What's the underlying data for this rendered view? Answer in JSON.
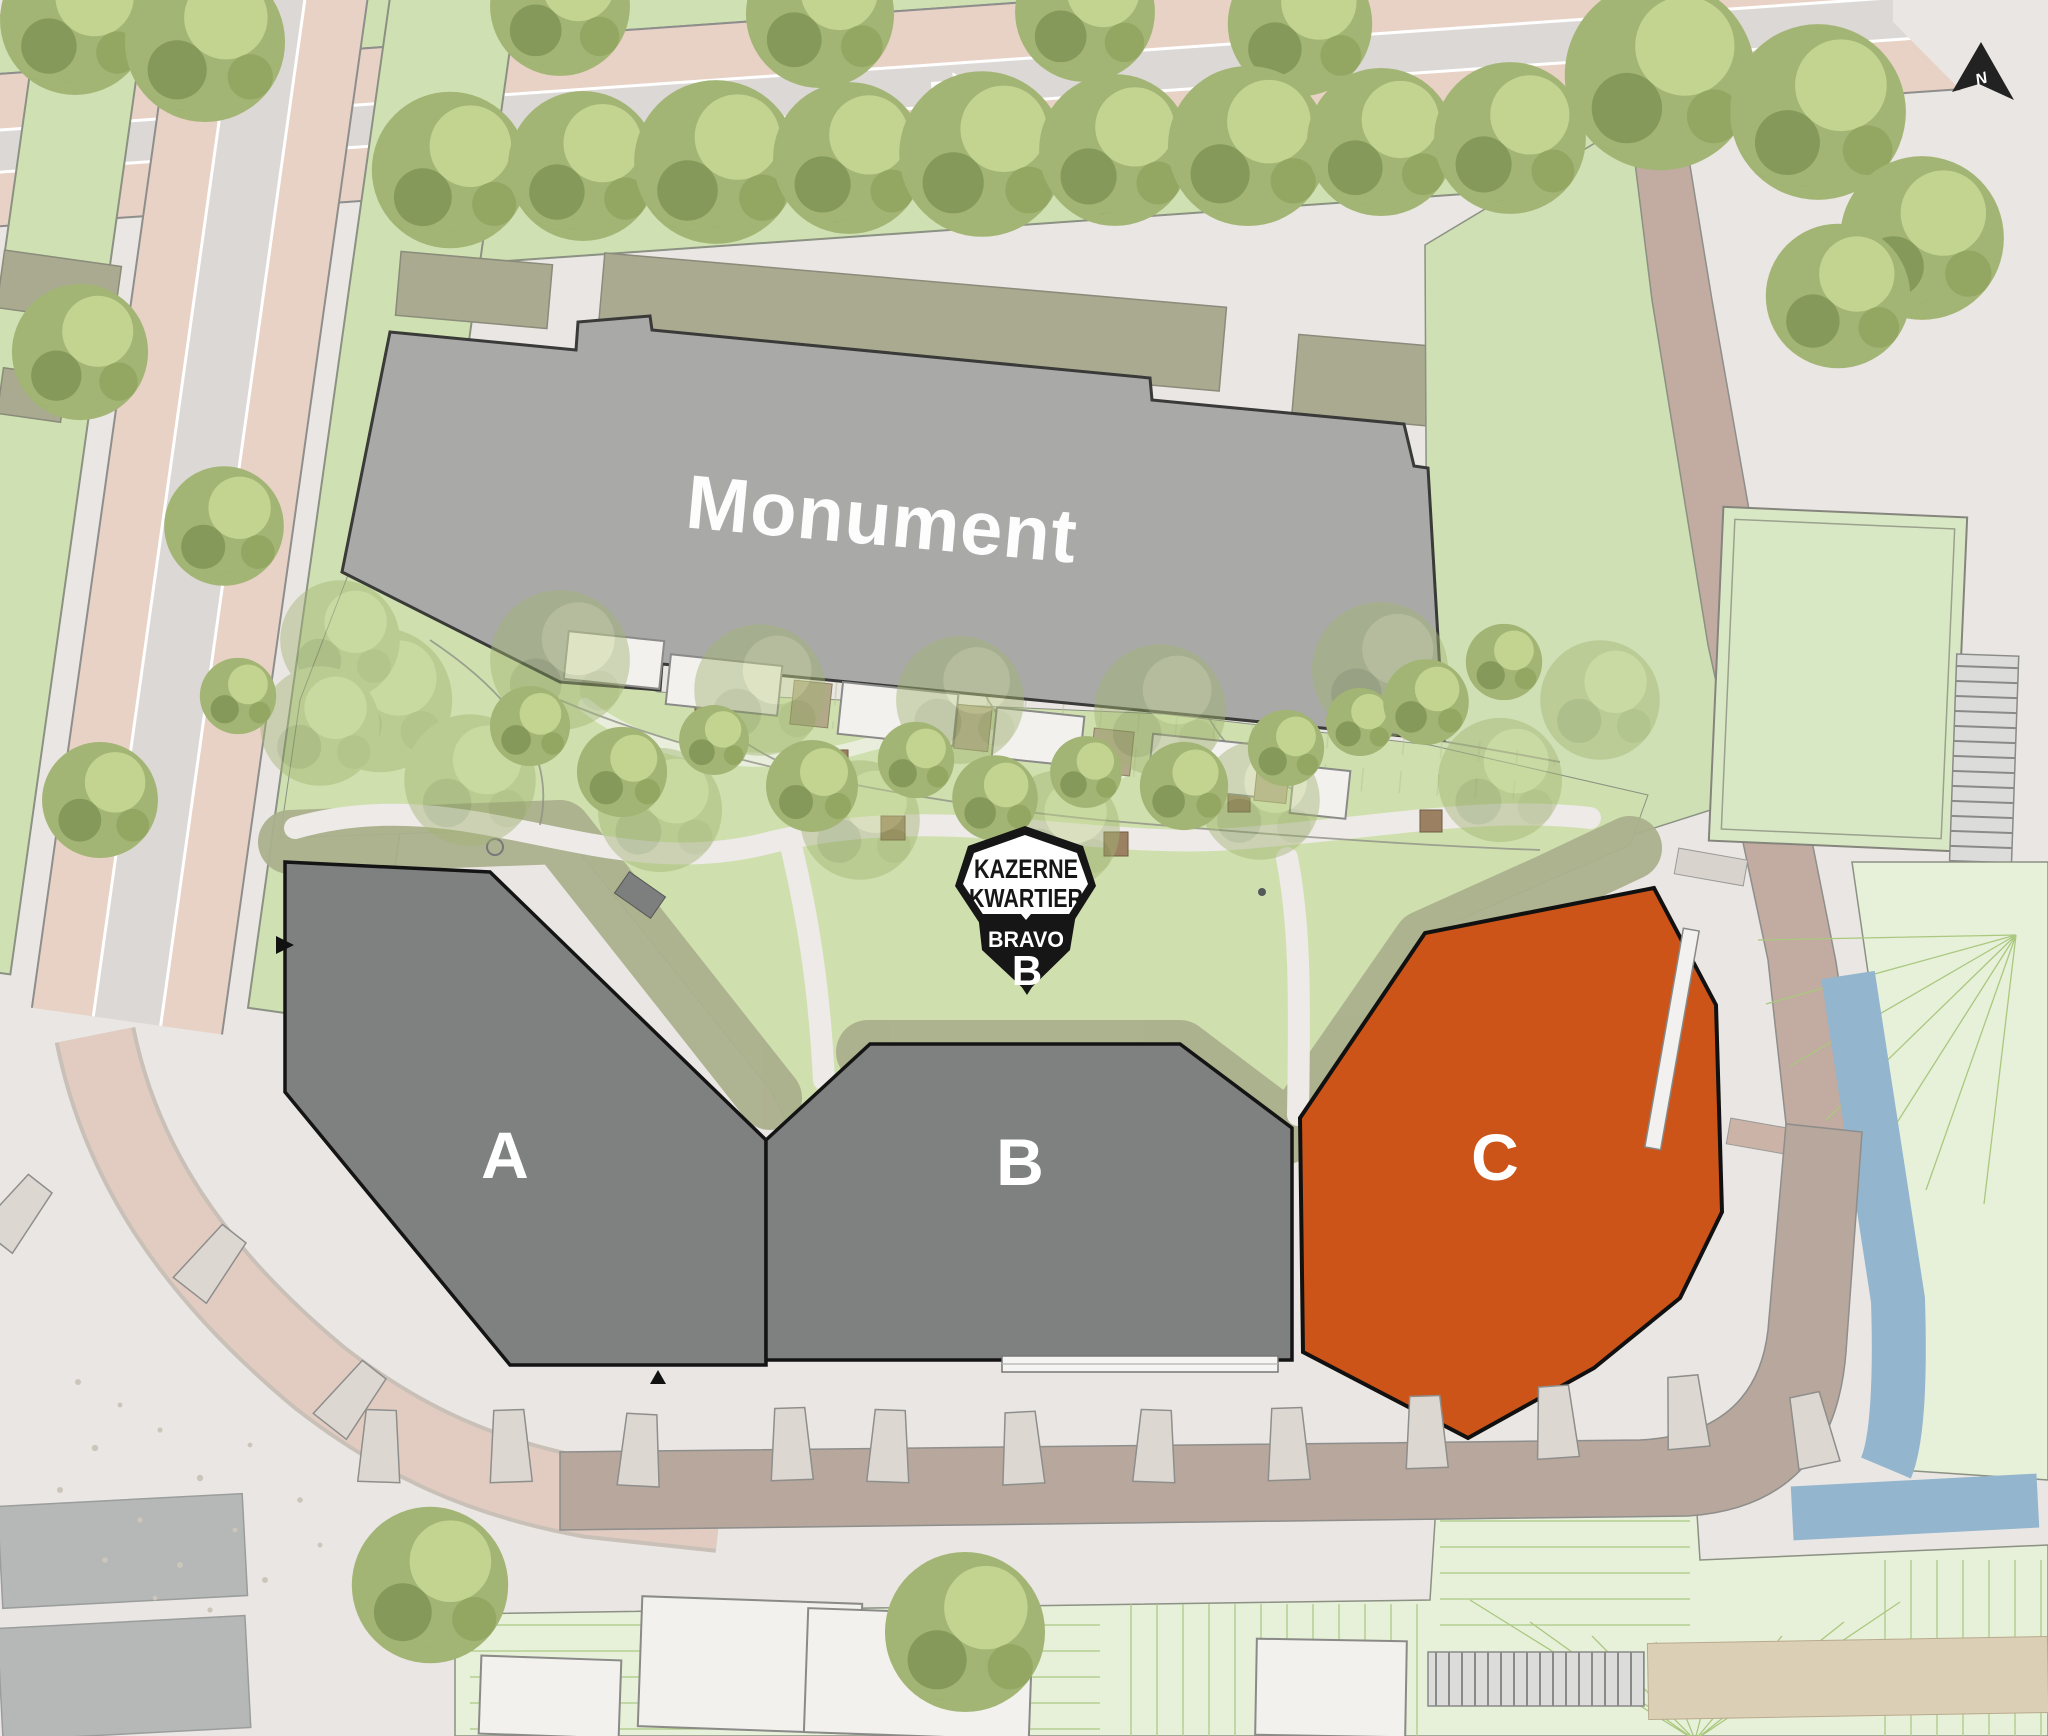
{
  "map": {
    "title": "Kazerne Kwartier site plan",
    "labels": {
      "monument": "Monument",
      "building_a": "A",
      "building_b": "B",
      "building_c": "C",
      "compass": "N"
    },
    "icons": {
      "compass": "north-arrow",
      "top_road_direction": "arrow-right",
      "left_road_direction": "arrow-down"
    }
  },
  "logo": {
    "line1": "KAZERNE",
    "line2": "KWARTIER",
    "line3": "BRAVO",
    "line4": "B"
  },
  "colors": {
    "pavement": "#eae6e3",
    "highlight_orange": "#cc5418",
    "building_gray": "#7e817f",
    "monument_gray": "#a9a9a8",
    "water_blue": "#93b5cd",
    "road_brown": "#b7a79c",
    "road_side_brown": "#c2aba0",
    "road_pink": "#e8d1c5",
    "road_gray_lane": "#dcd8d6",
    "green_strip": "#cfe1b2",
    "lawn_green": "#e7f0d9",
    "garden_light": "#cfe0ae",
    "garden_olive": "#abb08d",
    "logo_black": "#161616"
  }
}
